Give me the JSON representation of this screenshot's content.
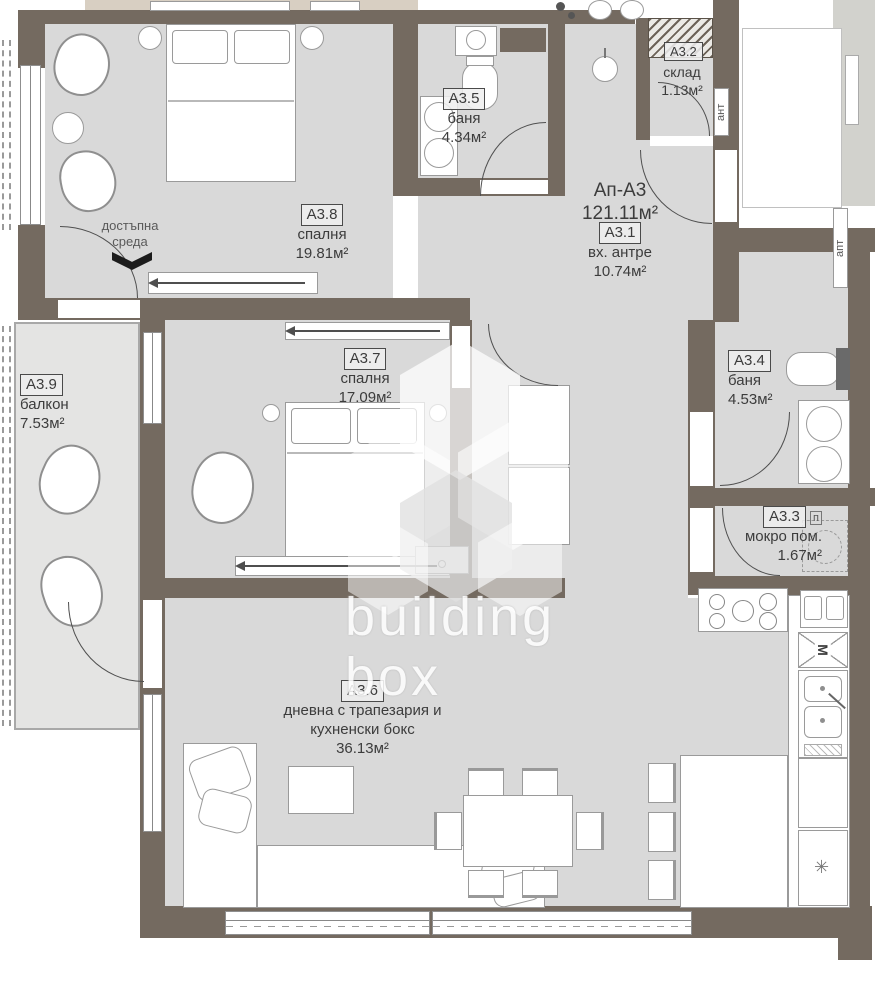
{
  "apartment": {
    "name": "Ап-А3",
    "area": "121.11м²"
  },
  "rooms": {
    "a31": {
      "code": "A3.1",
      "name": "вх. антре",
      "area": "10.74м²"
    },
    "a32": {
      "code": "A3.2"
    },
    "a33": {
      "code": "A3.3",
      "name": "мокро пом.",
      "area": "1.67м²"
    },
    "a34": {
      "code": "A3.4",
      "name": "баня",
      "area": "4.53м²"
    },
    "a35": {
      "code": "A3.5",
      "name": "баня",
      "area": "4.34м²"
    },
    "a36": {
      "code": "A3.6",
      "name": "дневна с трапезария и кухненски бокс",
      "area": "36.13м²"
    },
    "a37": {
      "code": "A3.7",
      "name": "спалня",
      "area": "17.09м²"
    },
    "a38": {
      "code": "A3.8",
      "name": "спалня",
      "area": "19.81м²"
    },
    "a39": {
      "code": "A3.9",
      "name": "балкон",
      "area": "7.53м²"
    },
    "storage": {
      "name": "склад",
      "area": "1.13м²"
    }
  },
  "annotations": {
    "accessible_line1": "достъпна",
    "accessible_line2": "среда",
    "vertical_left": "ант",
    "vertical_right": "апт",
    "freezer_symbol": "✳",
    "microwave_symbol": "М",
    "washer_symbol": "п"
  },
  "watermark": {
    "line1": "building",
    "line2": "box"
  },
  "colors": {
    "wall": "#746a60",
    "floor": "#d9d9d9",
    "balcony_floor": "#e4e4e3",
    "neighbor_floor": "#d8cfc2",
    "text": "#3c3c3c"
  }
}
